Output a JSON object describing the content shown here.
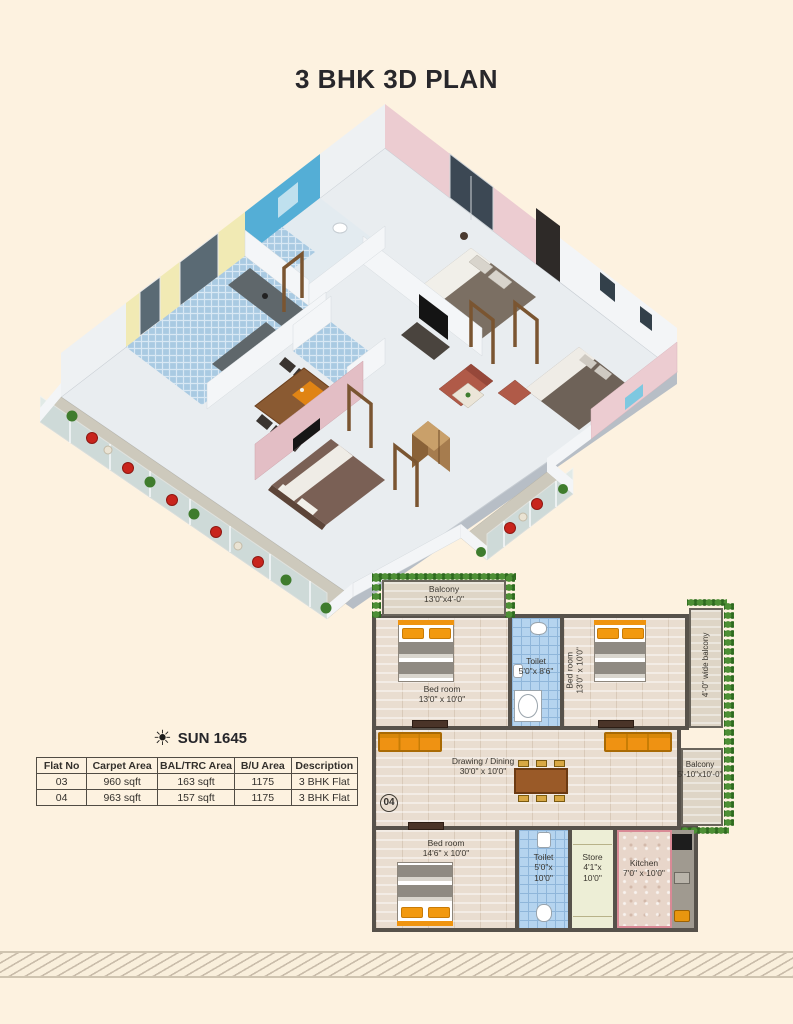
{
  "page": {
    "title": "3 BHK 3D PLAN"
  },
  "sun": {
    "icon": "sun-icon",
    "label": "SUN 1645"
  },
  "table": {
    "headers": [
      "Flat No",
      "Carpet Area",
      "BAL/TRC Area",
      "B/U Area",
      "Description"
    ],
    "rows": [
      {
        "flat_no": "03",
        "carpet_area": "960 sqft",
        "bal_trc_area": "163 sqft",
        "bu_area": "1175",
        "description": "3 BHK Flat"
      },
      {
        "flat_no": "04",
        "carpet_area": "963 sqft",
        "bal_trc_area": "157 sqft",
        "bu_area": "1175",
        "description": "3 BHK Flat"
      }
    ]
  },
  "plan2d": {
    "flat_number": "04",
    "rooms": {
      "balcony_top": {
        "name": "Balcony",
        "dims": "13'0\"x4'-0\""
      },
      "bedroom1": {
        "name": "Bed room",
        "dims": "13'0\" x 10'0\""
      },
      "toilet1": {
        "name": "Toilet",
        "dims": "5'0\"x 8'6\""
      },
      "bedroom2": {
        "name": "Bed room",
        "dims": "13'0\" x 10'0\""
      },
      "balcony_right": {
        "name": "4'-0\" wide balcony"
      },
      "drawing_dining": {
        "name": "Drawing / Dining",
        "dims": "30'0\" x 10'0\""
      },
      "balcony2": {
        "name": "Balcony",
        "dims": "5'-10\"x10'-0\""
      },
      "bedroom3": {
        "name": "Bed room",
        "dims": "14'6\" x 10'0\""
      },
      "toilet2": {
        "name": "Toilet",
        "dims": "5'0\"x",
        "dims2": "10'0\""
      },
      "store": {
        "name": "Store",
        "dims": "4'1\"x",
        "dims2": "10'0\""
      },
      "kitchen": {
        "name": "Kitchen",
        "dims": "7'0\" x 10'0\""
      }
    }
  },
  "colors": {
    "background": "#fdf2e0",
    "wall_dark": "#57524b",
    "furniture_orange": "#ef9212",
    "hedge_green": "#4d8f35",
    "tile_blue": "#b5d4ef",
    "chair_red": "#c8241c",
    "wall_pink_3d": "#ecccd1",
    "wall_yellow_3d": "#f1eab4",
    "wall_bluetile_3d": "#54aed6"
  }
}
